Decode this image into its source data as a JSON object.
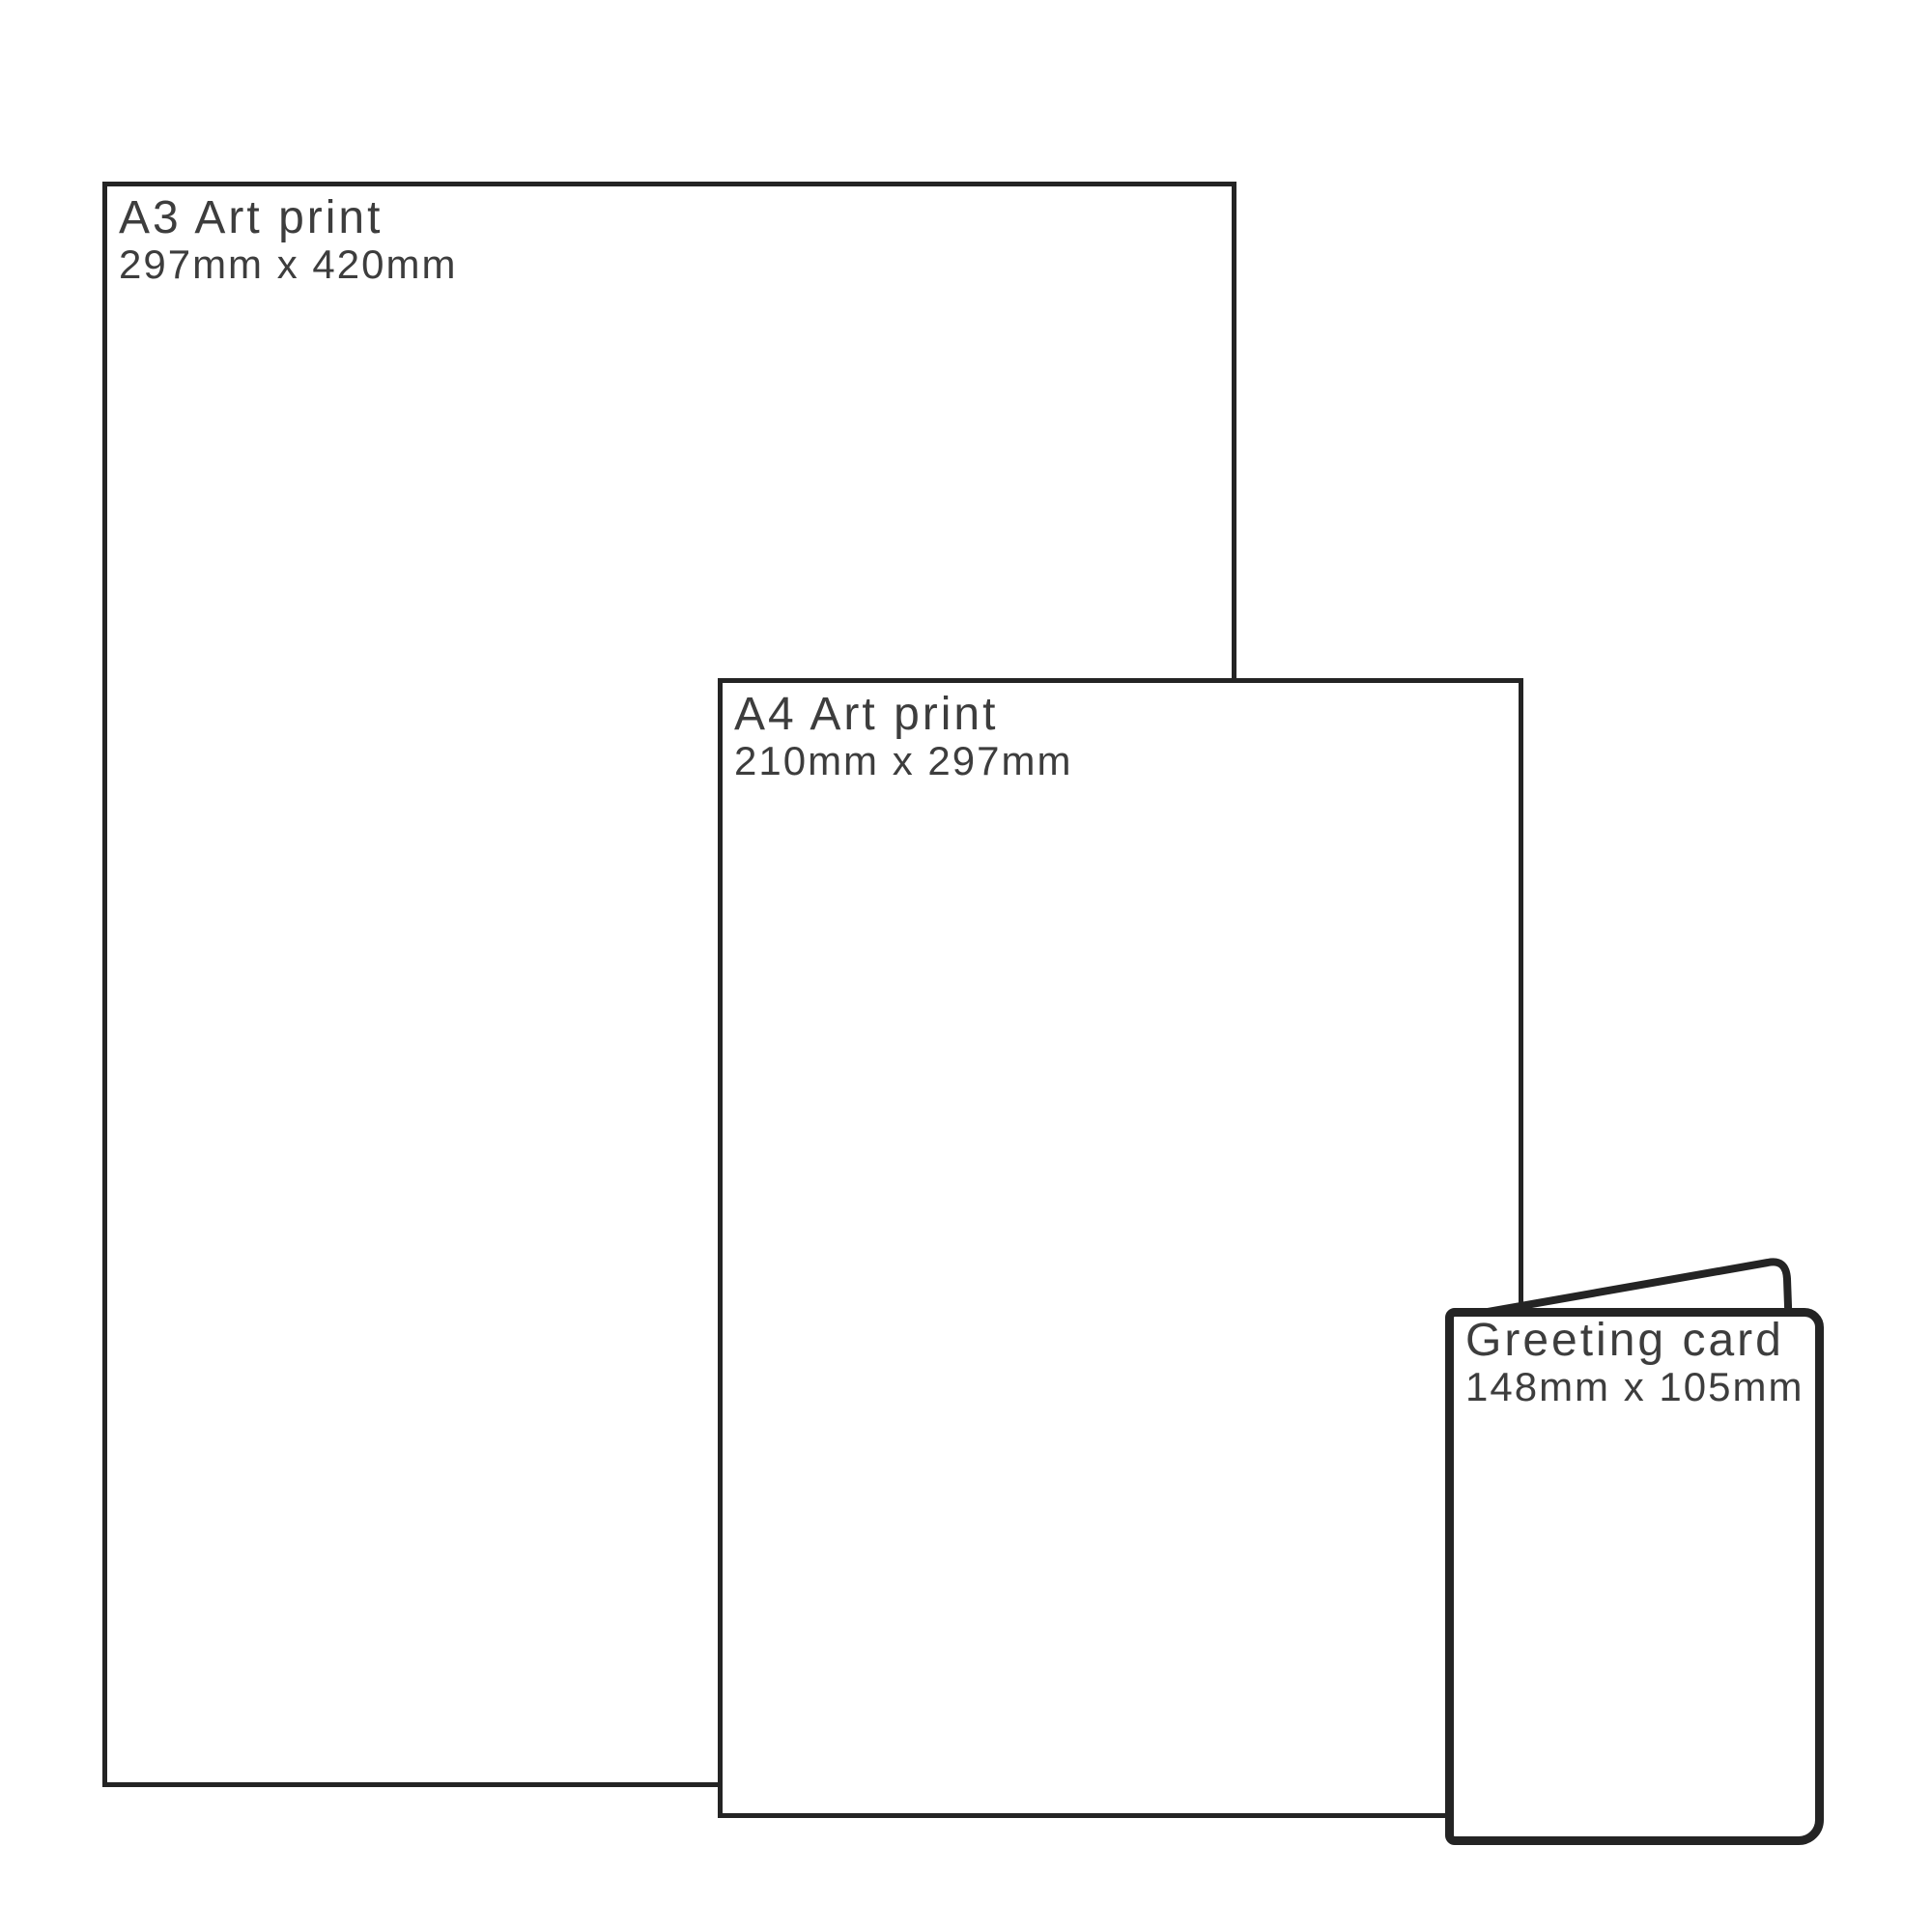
{
  "diagram": {
    "description_colors": {
      "background": "#ffffff",
      "outline": "#242424",
      "text": "#3d3d3d"
    },
    "items": {
      "a3": {
        "title": "A3 Art print",
        "dims": "297mm x 420mm"
      },
      "a4": {
        "title": "A4 Art print",
        "dims": "210mm x 297mm"
      },
      "card": {
        "title": "Greeting card",
        "dims": "148mm x 105mm"
      }
    }
  }
}
